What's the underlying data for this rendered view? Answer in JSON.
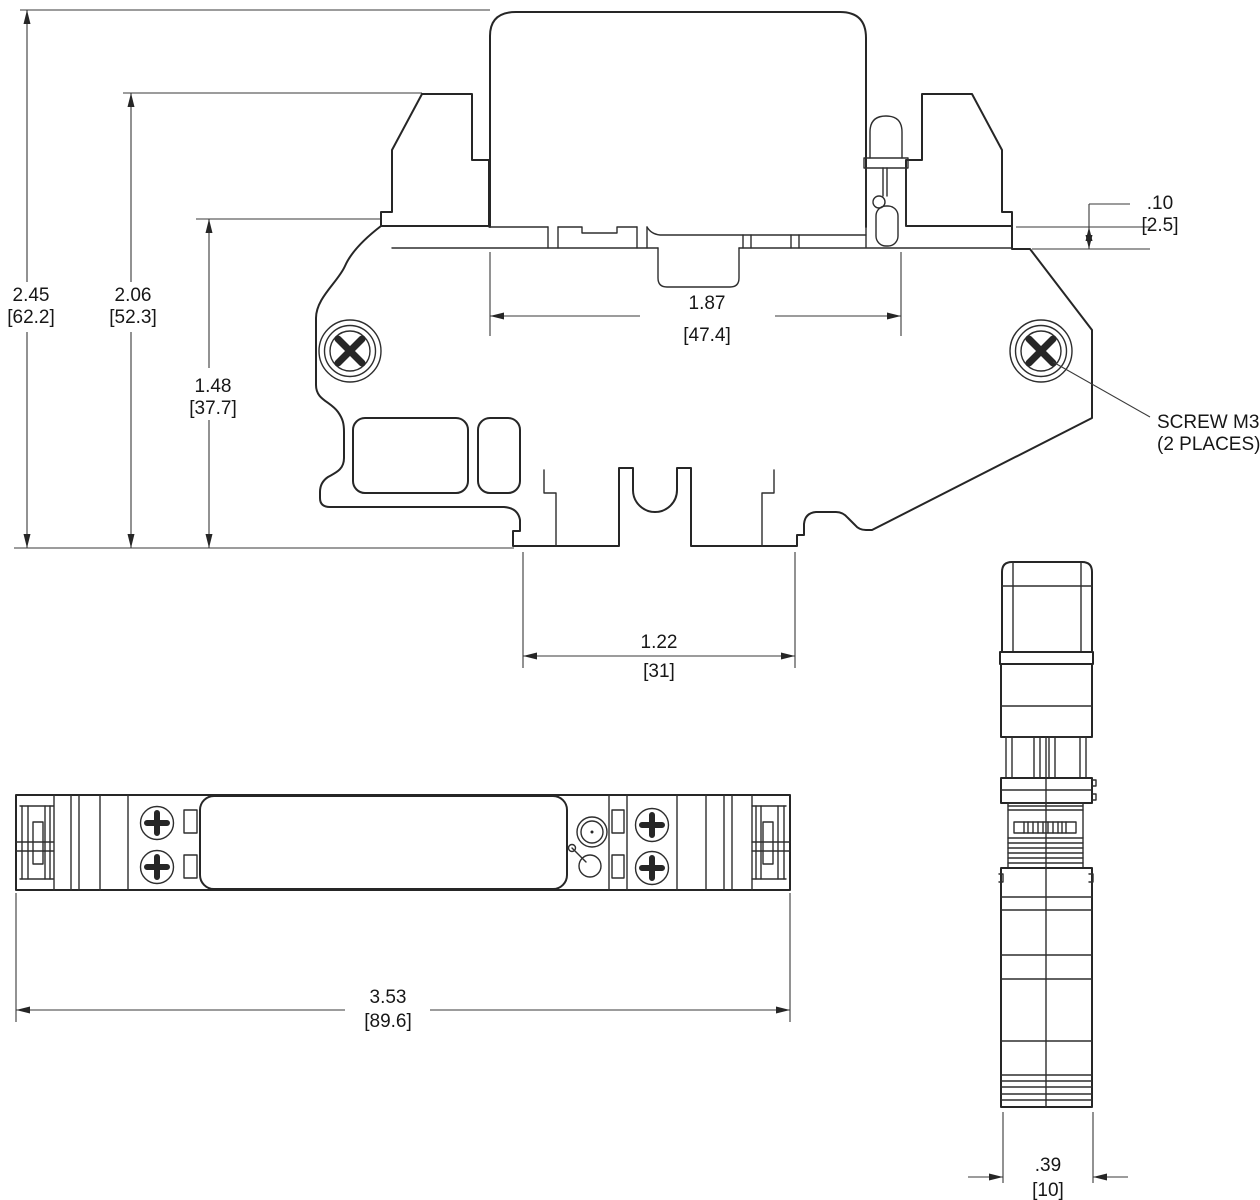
{
  "dims": {
    "overall_height_in": "2.45",
    "overall_height_mm": "[62.2]",
    "clamp_height_in": "2.06",
    "clamp_height_mm": "[52.3]",
    "base_height_in": "1.48",
    "base_height_mm": "[37.7]",
    "relay_width_in": "1.87",
    "relay_width_mm": "[47.4]",
    "step_in": ".10",
    "step_mm": "[2.5]",
    "foot_width_in": "1.22",
    "foot_width_mm": "[31]",
    "overall_length_in": "3.53",
    "overall_length_mm": "[89.6]",
    "end_width_in": ".39",
    "end_width_mm": "[10]"
  },
  "notes": {
    "screw_line1": "SCREW M3",
    "screw_line2": "(2 PLACES)"
  },
  "colors": {
    "line": "#262626",
    "dim": "#3a3a3a",
    "background": "#ffffff"
  }
}
